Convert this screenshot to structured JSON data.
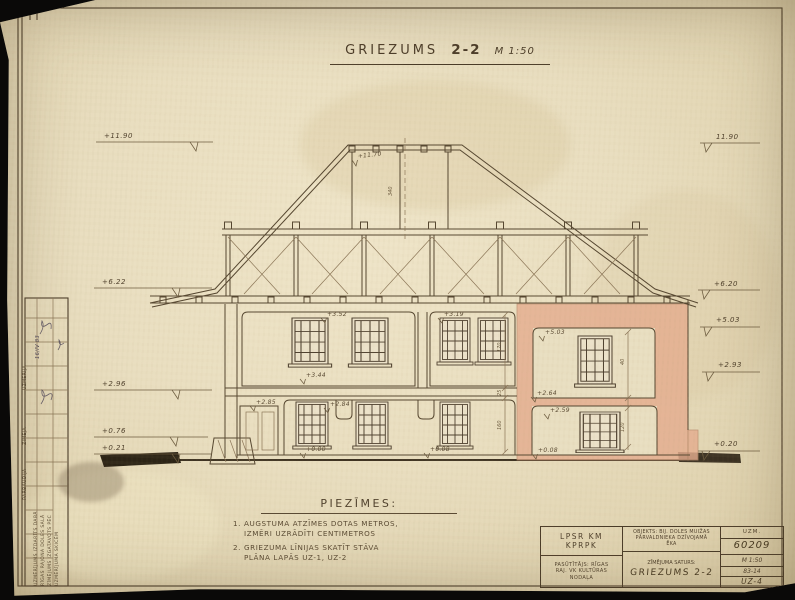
{
  "sheet": {
    "title_label": "GRIEZUMS",
    "title_number": "2-2",
    "title_scale": "M 1:50"
  },
  "elevations": {
    "left": [
      "+11.90",
      "+6.22",
      "+2.96",
      "+0.76",
      "+0.21"
    ],
    "right": [
      "11.90",
      "+6.20",
      "+5.03",
      "+2.93",
      "+0.20"
    ],
    "ridge": "+11.70",
    "interior": {
      "u1_top": "+3.52",
      "u1_floor": "+3.44",
      "u2_top": "+3.19",
      "l1_ceiling_a": "+2.85",
      "l1_ceiling_b": "+2.84",
      "l1_floor": "+0.00",
      "l1_floor_b": "+0.08",
      "wing_ceiling": "+5.03",
      "wing_floor": "+2.64",
      "wing_low_ceiling": "+2.59",
      "wing_low_floor": "+0.08"
    }
  },
  "dims": {
    "values": [
      "170",
      "25",
      "160",
      "40",
      "120",
      "340"
    ]
  },
  "notes": {
    "heading": "PIEZĪMES:",
    "item1_line1": "1. AUGSTUMA ATZĪMES DOTAS METROS,",
    "item1_line2": "IZMĒRI UZRĀDĪTI CENTIMETROS",
    "item2_line1": "2. GRIEZUMA LĪNIJAS SKATĪT STĀVA",
    "item2_line2": "PLĀNA LAPĀS UZ-1, UZ-2"
  },
  "titleblock": {
    "org_line1": "LPSR KM",
    "org_line2": "KPRPK",
    "client_line1": "PASŪTĪTĀJS: RĪGAS",
    "client_line2": "RAJ. VK KULTŪRAS",
    "client_line3": "NODAĻA",
    "object_line1": "OBJEKTS: BIJ. DOLES MUIŽAS",
    "object_line2": "PĀRVALDNIEKA DZĪVOJAMĀ",
    "object_line3": "ĒKA",
    "content_label": "ZĪMĒJUMA SATURS:",
    "content_value": "GRIEZUMS 2-2",
    "uzm_label": "UZM.",
    "uzm_number": "60209",
    "scale": "M 1:50",
    "code": "83-14",
    "sheet_number": "UZ-4"
  },
  "stamp": {
    "h1": "UZMĒRĪJA",
    "h2": "ZĪMĒJA",
    "h3": "PĀRBAUDĪJA",
    "date": "16/IV 83",
    "n1": "UZMĒRĪJUMS IZDARĪTS DABĀ",
    "n2": "RĪGAS RAJONA DOLES SALĀ",
    "n3": "ZĪMĒJUMS IZGATAVOTS PĒC",
    "n4": "UZMĒRĪJUMA SKICĒM"
  },
  "colors": {
    "paper": "#e9dec0",
    "ink": "#54452f",
    "poche_pink": "#e5ad8f"
  }
}
